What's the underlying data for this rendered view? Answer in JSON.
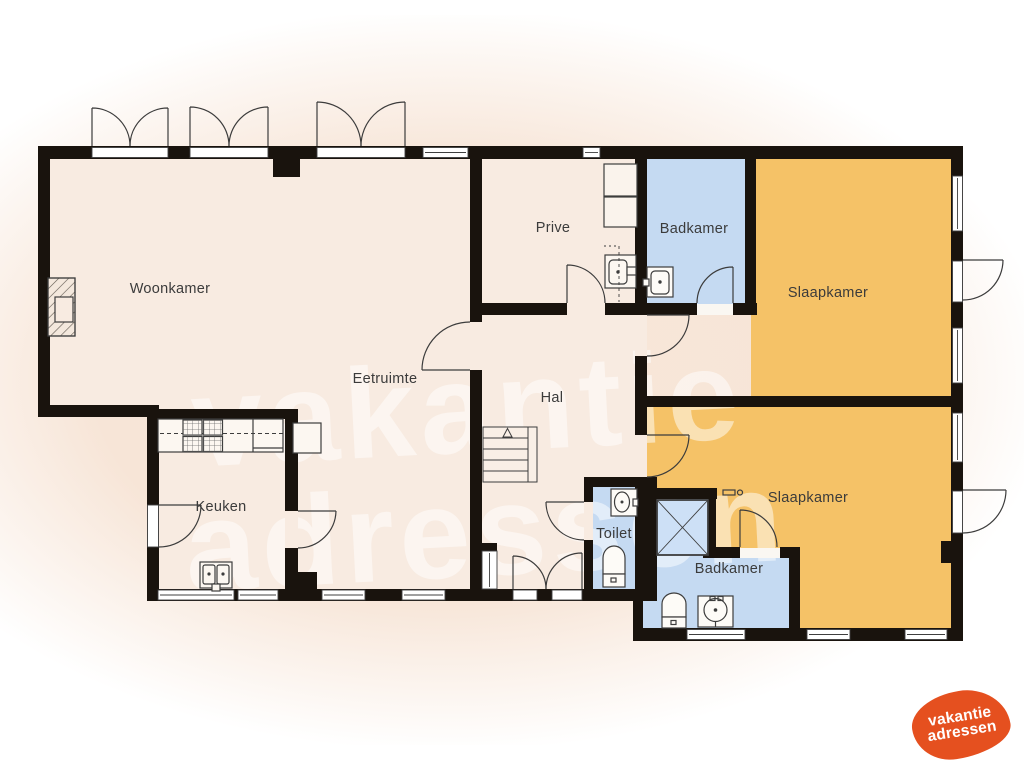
{
  "floorplan": {
    "rooms": [
      {
        "id": "woonkamer",
        "label": "Woonkamer"
      },
      {
        "id": "eetruimte",
        "label": "Eetruimte"
      },
      {
        "id": "prive",
        "label": "Prive"
      },
      {
        "id": "badkamer_boven",
        "label": "Badkamer"
      },
      {
        "id": "slaapkamer_boven",
        "label": "Slaapkamer"
      },
      {
        "id": "hal",
        "label": "Hal"
      },
      {
        "id": "keuken",
        "label": "Keuken"
      },
      {
        "id": "toilet",
        "label": "Toilet"
      },
      {
        "id": "badkamer_beneden",
        "label": "Badkamer"
      },
      {
        "id": "slaapkamer_beneden",
        "label": "Slaapkamer"
      }
    ],
    "colors": {
      "wall": "#19130d",
      "floor_living": "#f8ebe1",
      "floor_bedroom": "#f5c267",
      "floor_bath": "#c5daf2",
      "background_tint": "#f8e7da",
      "fixture_stroke": "#3d3d3d"
    },
    "fixtures": [
      "fireplace",
      "stove",
      "kitchen-sink",
      "stairs",
      "cabinet",
      "washbasin",
      "toilet",
      "shower"
    ]
  },
  "watermark": {
    "line1": "vakantie",
    "line2": "adressen"
  },
  "logo": {
    "line1": "vakantie",
    "line2": "adressen",
    "color": "#e5501f"
  }
}
